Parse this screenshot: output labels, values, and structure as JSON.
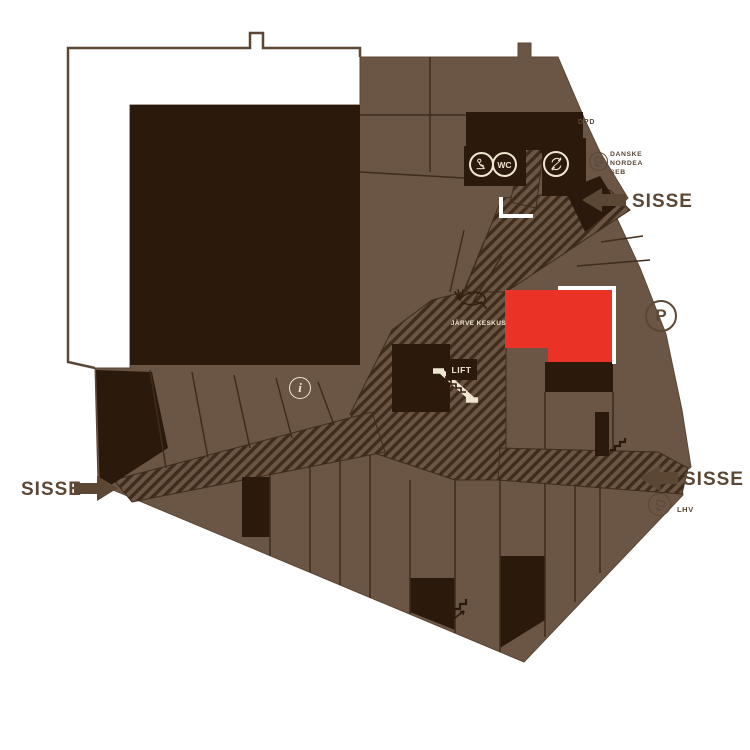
{
  "labels": {
    "entrance_left": "SISSE",
    "entrance_top_right": "SISSE",
    "entrance_bottom_right": "SISSE",
    "dpd": "DPD",
    "banks": [
      "DANSKE",
      "NORDEA",
      "SEB"
    ],
    "lhv": "LHV",
    "lift": "LIFT",
    "wc": "WC",
    "parking": "P",
    "info": "i",
    "logo": "JÄRVE KESKUS"
  },
  "colors": {
    "background": "#FFFFFF",
    "floor": "#6B5646",
    "store_block": "#2B1A0C",
    "hatch_stripe": "#3F2C1B",
    "accent_red": "#EA3226",
    "label_brown": "#5B4734",
    "cream": "#F0E6D0",
    "white": "#FFFFFF"
  },
  "icons": {
    "atm": "circle with hand holding banknote",
    "wc": "circle with WC text",
    "currency_exchange": "circle with two circular arrows",
    "service_person": "circle with seated person figure",
    "parking": "circle with P",
    "info": "circle with italic i",
    "lift": "dark box with LIFT text",
    "escalator": "cream diagonal escalator glyph",
    "stairs": "step zigzag glyph",
    "entrance_arrow": "solid block arrow",
    "logo_deer": "leaping deer outline"
  }
}
